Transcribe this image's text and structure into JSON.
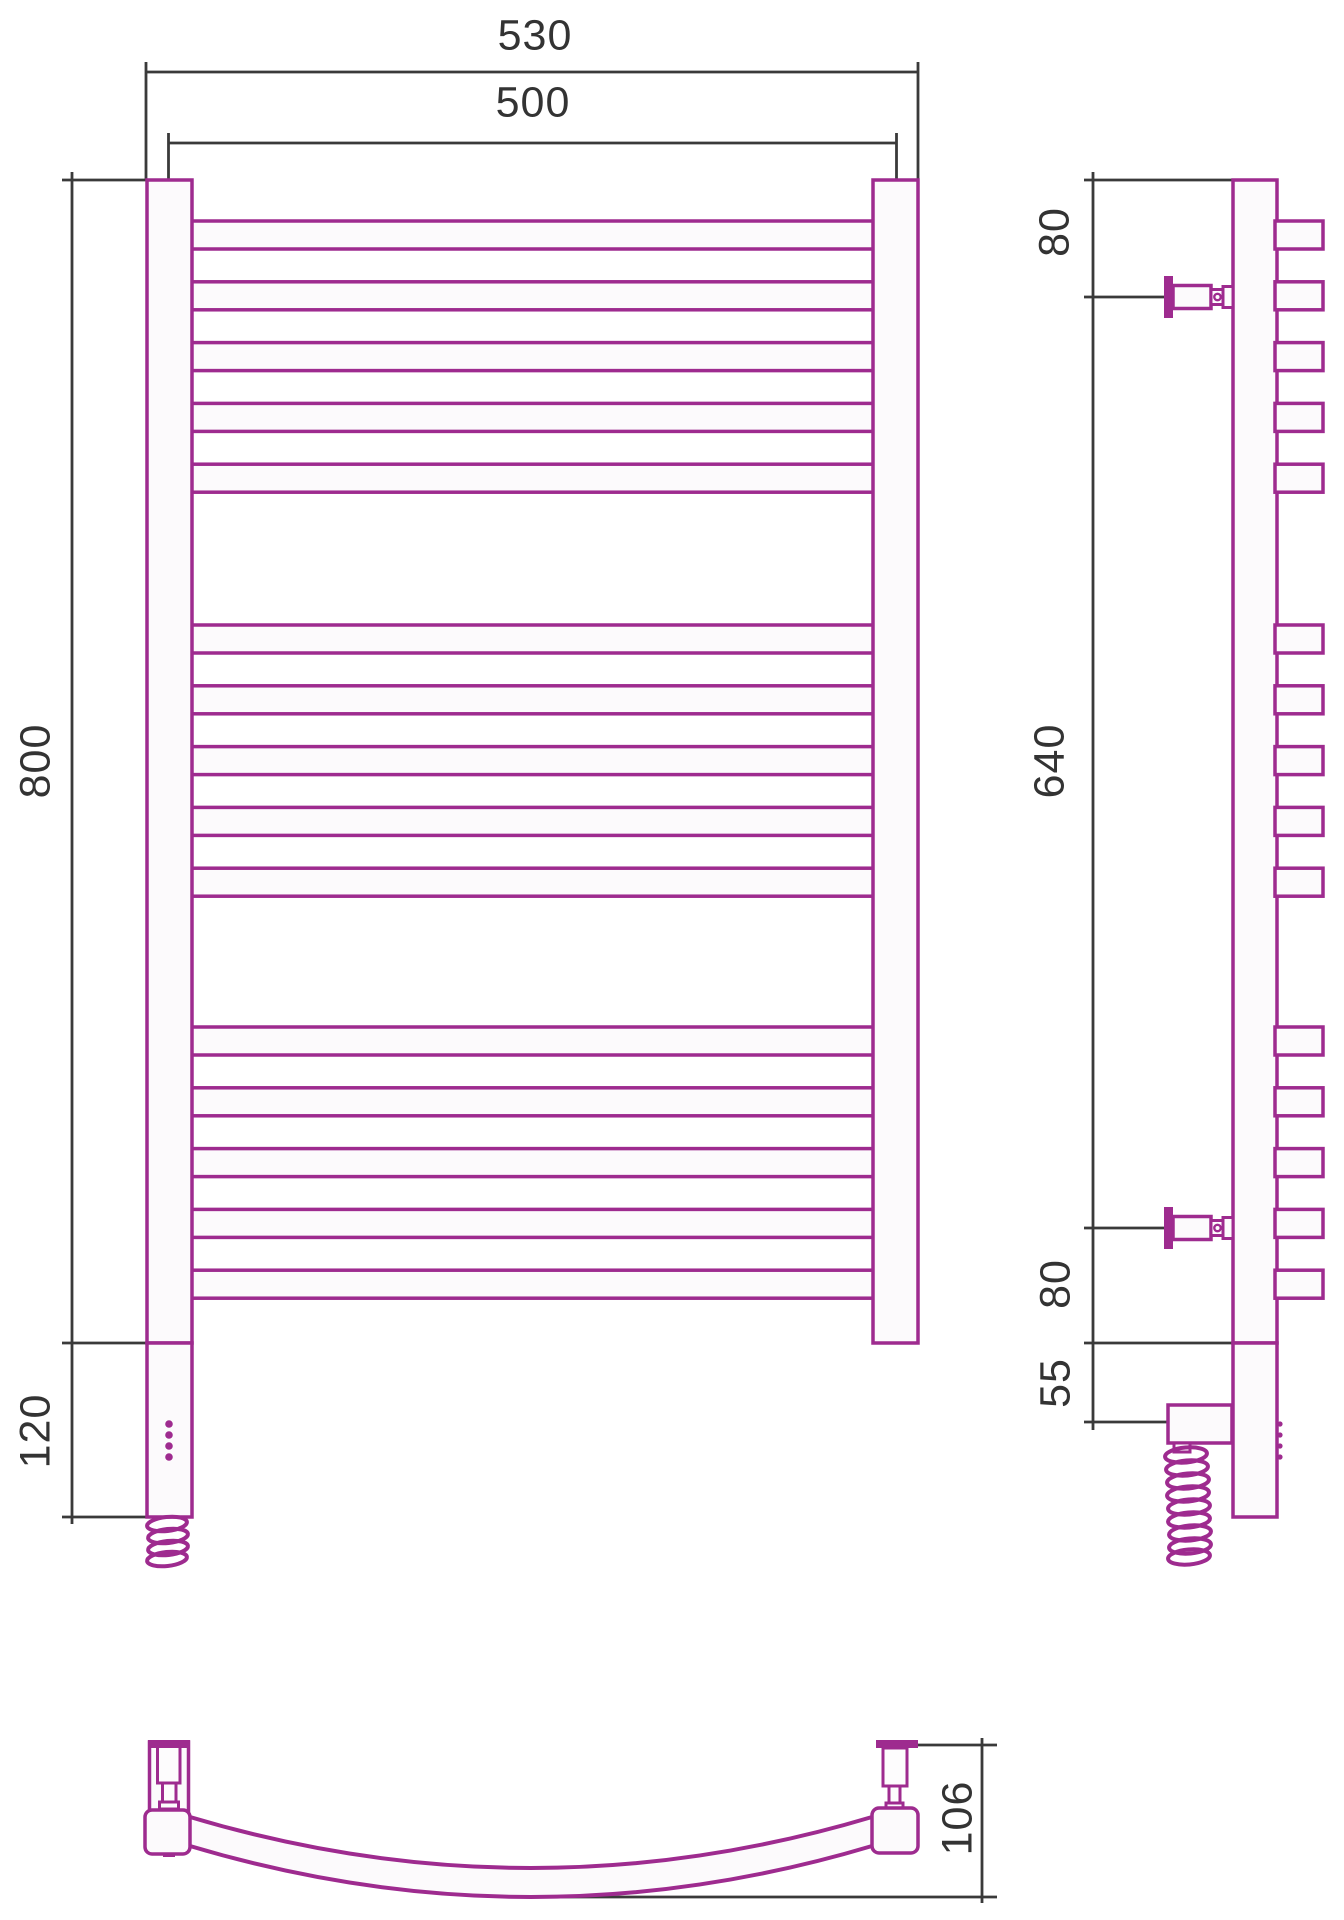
{
  "drawing_type": "towel-rail three-view technical drawing",
  "colors": {
    "outline": "#9E2B8F",
    "dimension_lines": "#3A3A3A",
    "text": "#333333"
  },
  "front_view": {
    "dim_overall_width": "530",
    "dim_post_centers_width": "500",
    "dim_height": "800",
    "dim_heater_section_height": "120",
    "bars_per_group": [
      5,
      5,
      5
    ],
    "bar_count": 15
  },
  "side_view": {
    "dim_top_to_bracket": "80",
    "dim_bracket_span": "640",
    "dim_bracket_to_bottom": "80",
    "dim_heater_drop": "55"
  },
  "bottom_view": {
    "dim_arc_depth": "106"
  }
}
